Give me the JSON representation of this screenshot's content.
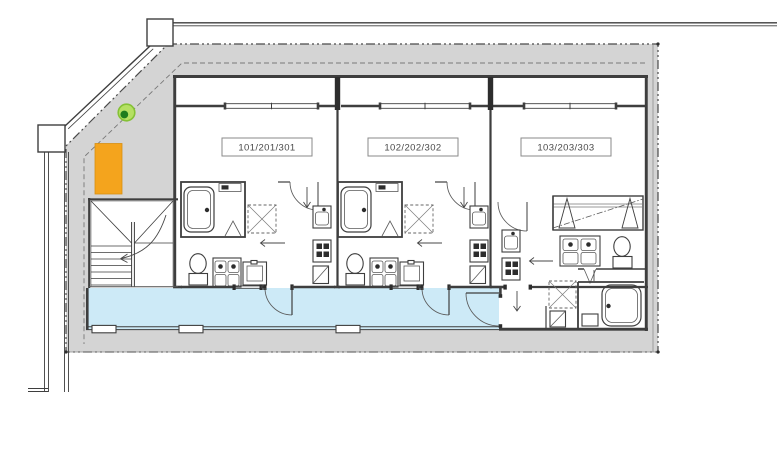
{
  "plan": {
    "type": "apartment-floor-plan",
    "units": [
      {
        "label": "101/201/301"
      },
      {
        "label": "102/202/302"
      },
      {
        "label": "103/203/303"
      }
    ],
    "colors": {
      "setback_gray": "#d4d4d4",
      "corridor_blue": "#cdeaf7",
      "highlight_orange": "#f4a41d",
      "highlight_orange_edge": "#d78f12",
      "marker_green_outer": "#b5e063",
      "marker_green_ring": "#85c236",
      "marker_green_inner": "#1e7d1e",
      "line_dark": "#3e3e3e",
      "line_light": "#8d8d8d",
      "label_text": "#4a4a4a"
    }
  }
}
